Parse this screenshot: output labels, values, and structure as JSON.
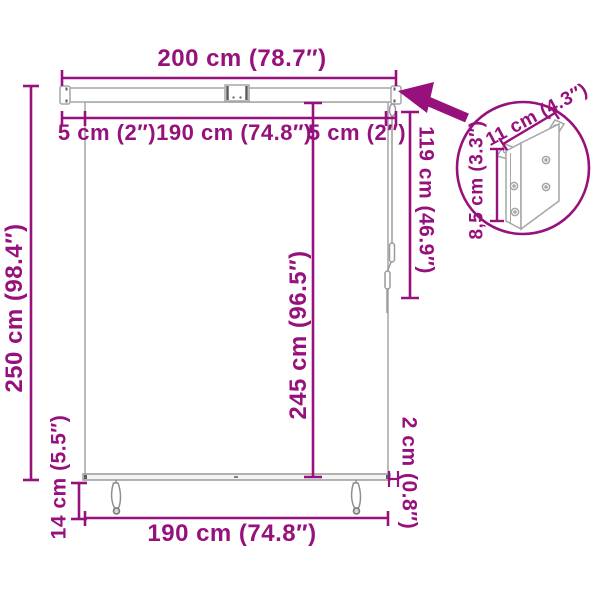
{
  "page": {
    "background": "#ffffff",
    "accent_color": "#97117C",
    "product_line_color": "#A6A6A6"
  },
  "labels": {
    "width_total": "200 cm (78.7″)",
    "gap_left": "5 cm (2″)",
    "width_inner_top": "190 cm (74.8″)",
    "gap_right": "5 cm (2″)",
    "height_total": "250 cm (98.4″)",
    "height_drop": "245 cm (96.5″)",
    "cord_length": "119 cm (46.9″)",
    "width_bottom": "190 cm (74.8″)",
    "handle_offset": "14 cm (5.5″)",
    "side_offset": "2 cm (0.8″)",
    "bracket_width": "11 cm (4.3″)",
    "bracket_depth": "8,5 cm (3.3″)"
  },
  "icons": {
    "callout_arrow": "arrow-pointing-to-bracket-position",
    "bracket_inset": "wall-mount-bracket-detail-circle"
  }
}
